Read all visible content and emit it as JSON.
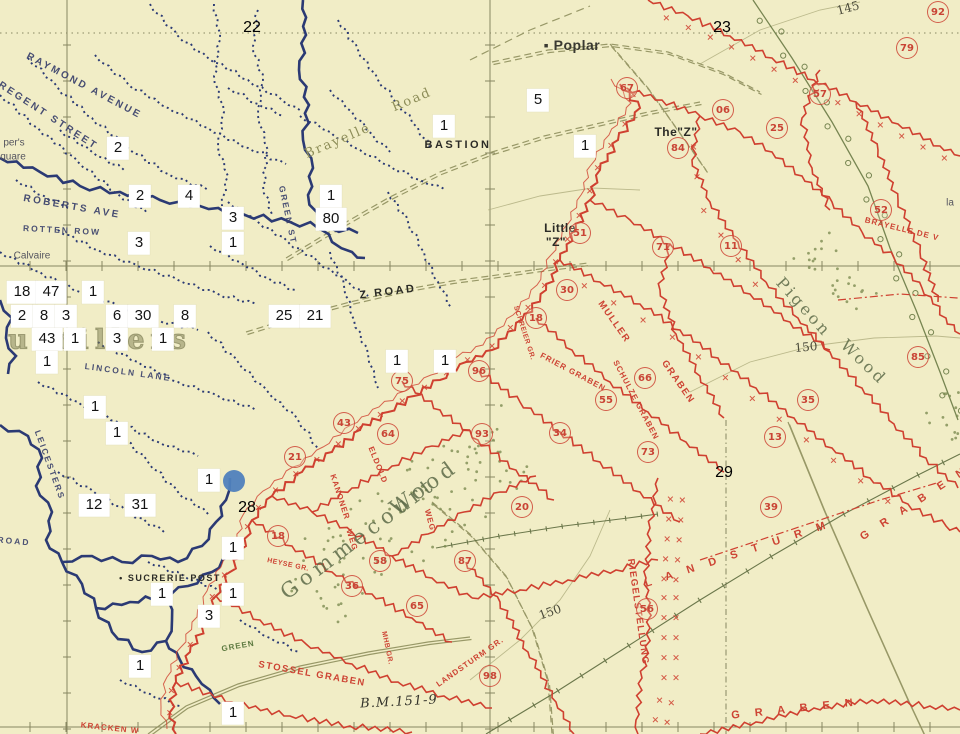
{
  "colors": {
    "background": "#f1edc6",
    "british_trench_blue": "#2b3a74",
    "german_trench_red": "#cf4030",
    "road_olive": "#8f8f5d",
    "wood_green": "#7d8c52",
    "grid_olive": "#6e6e49",
    "annotation_box_bg": "#ffffff",
    "annotation_text": "#141414",
    "marker_blue": "#4f81bd"
  },
  "grid_square_numbers": [
    {
      "text": "22",
      "x": 252,
      "y": 28
    },
    {
      "text": "23",
      "x": 722,
      "y": 28
    },
    {
      "text": "28",
      "x": 247,
      "y": 508
    },
    {
      "text": "29",
      "x": 724,
      "y": 473
    }
  ],
  "map_labels": [
    {
      "text": "RAYMOND AVENUE",
      "x": 84,
      "y": 86,
      "rot": 28,
      "cls": "street"
    },
    {
      "text": "REGENT STREET",
      "x": 48,
      "y": 116,
      "rot": 33,
      "cls": "street"
    },
    {
      "text": "ROBERTS AVE",
      "x": 72,
      "y": 207,
      "rot": 10,
      "cls": "street"
    },
    {
      "text": "ROTTEN ROW",
      "x": 62,
      "y": 230,
      "rot": 3,
      "cls": "street-small"
    },
    {
      "text": "GREEN ST",
      "x": 288,
      "y": 215,
      "rot": 78,
      "cls": "street-small"
    },
    {
      "text": "per's",
      "x": 14,
      "y": 143,
      "rot": 0,
      "cls": "frag"
    },
    {
      "text": "quare",
      "x": 13,
      "y": 157,
      "rot": 0,
      "cls": "frag"
    },
    {
      "text": "Calvaire",
      "x": 32,
      "y": 256,
      "rot": 0,
      "cls": "frag"
    },
    {
      "text": "LINCOLN LANE",
      "x": 128,
      "y": 372,
      "rot": 8,
      "cls": "street-small"
    },
    {
      "text": "LEICESTERS",
      "x": 50,
      "y": 465,
      "rot": 70,
      "cls": "street-small"
    },
    {
      "text": "ROAD",
      "x": 14,
      "y": 541,
      "rot": 5,
      "cls": "street-small"
    },
    {
      "text": "• SUCRERIE POST",
      "x": 170,
      "y": 578,
      "rot": 0,
      "cls": "caps-small"
    },
    {
      "text": "BASTION",
      "x": 458,
      "y": 145,
      "rot": 0,
      "cls": "caps"
    },
    {
      "text": "Z ROAD",
      "x": 388,
      "y": 292,
      "rot": -7,
      "cls": "caps"
    },
    {
      "text": "▪ Poplar",
      "x": 572,
      "y": 45,
      "rot": 0,
      "cls": "poplar"
    },
    {
      "text": "The\"Z\"",
      "x": 676,
      "y": 132,
      "rot": 0,
      "cls": "caps-mid"
    },
    {
      "text": "Little",
      "x": 560,
      "y": 228,
      "rot": 0,
      "cls": "caps-mid"
    },
    {
      "text": "\"Z\"",
      "x": 556,
      "y": 242,
      "rot": 0,
      "cls": "caps-mid"
    },
    {
      "text": "Gommecourt",
      "x": 358,
      "y": 538,
      "rot": -37,
      "cls": "wood-big"
    },
    {
      "text": "Wood",
      "x": 424,
      "y": 487,
      "rot": -36,
      "cls": "wood-big"
    },
    {
      "text": "Pigeon",
      "x": 804,
      "y": 307,
      "rot": 48,
      "cls": "wood-mid"
    },
    {
      "text": "Wood",
      "x": 864,
      "y": 362,
      "rot": 44,
      "cls": "wood-mid"
    },
    {
      "text": "Brayelle",
      "x": 338,
      "y": 141,
      "rot": -23,
      "cls": "road-name"
    },
    {
      "text": "Road",
      "x": 412,
      "y": 100,
      "rot": -23,
      "cls": "road-name"
    },
    {
      "text": "la",
      "x": 950,
      "y": 203,
      "rot": 0,
      "cls": "frag"
    },
    {
      "text": "145",
      "x": 848,
      "y": 8,
      "rot": -15,
      "cls": "contour"
    },
    {
      "text": "150",
      "x": 806,
      "y": 347,
      "rot": -5,
      "cls": "contour"
    },
    {
      "text": "150",
      "x": 550,
      "y": 612,
      "rot": -20,
      "cls": "contour"
    },
    {
      "text": "B.M.151-9",
      "x": 399,
      "y": 702,
      "rot": -3,
      "cls": "bm"
    },
    {
      "text": "GREEN",
      "x": 238,
      "y": 646,
      "rot": -10,
      "cls": "green-frag"
    },
    {
      "text": "uevillers",
      "x": 100,
      "y": 340,
      "rot": 0,
      "cls": "village"
    }
  ],
  "trench_name_labels": [
    {
      "text": "BRAYELLE DE V",
      "x": 902,
      "y": 229,
      "rot": 14,
      "cls": "red-name-sm"
    },
    {
      "text": "MULLER",
      "x": 614,
      "y": 322,
      "rot": 55,
      "cls": "red-name"
    },
    {
      "text": "GRABEN",
      "x": 678,
      "y": 382,
      "rot": 55,
      "cls": "red-name"
    },
    {
      "text": "FRIER GRABEN",
      "x": 573,
      "y": 372,
      "rot": 28,
      "cls": "red-name-sm"
    },
    {
      "text": "SCHULZE GRABEN",
      "x": 636,
      "y": 400,
      "rot": 62,
      "cls": "red-name-sm"
    },
    {
      "text": "SCHREIER GR.",
      "x": 524,
      "y": 333,
      "rot": 72,
      "cls": "red-name-tiny"
    },
    {
      "text": "KANONER",
      "x": 340,
      "y": 497,
      "rot": 72,
      "cls": "red-name-sm"
    },
    {
      "text": "WEG",
      "x": 352,
      "y": 540,
      "rot": 72,
      "cls": "red-name-sm"
    },
    {
      "text": "ELDOLD",
      "x": 378,
      "y": 465,
      "rot": 68,
      "cls": "red-name-sm"
    },
    {
      "text": "WEG",
      "x": 430,
      "y": 520,
      "rot": 75,
      "cls": "red-name-sm"
    },
    {
      "text": "STOSSEL GRABEN",
      "x": 312,
      "y": 674,
      "rot": 10,
      "cls": "red-name"
    },
    {
      "text": "RIEGELSTELLUNG",
      "x": 638,
      "y": 612,
      "rot": 82,
      "cls": "red-name"
    },
    {
      "text": "LANDSTURM GR.",
      "x": 470,
      "y": 662,
      "rot": -35,
      "cls": "red-name-sm"
    },
    {
      "text": "L A N D S T U R M",
      "x": 738,
      "y": 554,
      "rot": -18,
      "cls": "red-spread"
    },
    {
      "text": "G R A B E N",
      "x": 915,
      "y": 503,
      "rot": -33,
      "cls": "red-spread"
    },
    {
      "text": "G R A B E N",
      "x": 795,
      "y": 709,
      "rot": -6,
      "cls": "red-spread"
    },
    {
      "text": "KRACKEN W",
      "x": 110,
      "y": 728,
      "rot": 6,
      "cls": "red-name-sm"
    },
    {
      "text": "MHB GR.",
      "x": 387,
      "y": 648,
      "rot": 78,
      "cls": "red-name-tiny"
    },
    {
      "text": "HEYSE GR.",
      "x": 288,
      "y": 565,
      "rot": 12,
      "cls": "red-name-tiny"
    }
  ],
  "circled_numbers": [
    {
      "n": "92",
      "x": 938,
      "y": 12
    },
    {
      "n": "79",
      "x": 907,
      "y": 48
    },
    {
      "n": "67",
      "x": 627,
      "y": 88
    },
    {
      "n": "57",
      "x": 820,
      "y": 94
    },
    {
      "n": "06",
      "x": 723,
      "y": 110
    },
    {
      "n": "25",
      "x": 777,
      "y": 128
    },
    {
      "n": "84",
      "x": 678,
      "y": 148
    },
    {
      "n": "52",
      "x": 881,
      "y": 210
    },
    {
      "n": "51",
      "x": 580,
      "y": 233
    },
    {
      "n": "71",
      "x": 663,
      "y": 247
    },
    {
      "n": "11",
      "x": 731,
      "y": 246
    },
    {
      "n": "30",
      "x": 567,
      "y": 290
    },
    {
      "n": "18",
      "x": 536,
      "y": 318
    },
    {
      "n": "96",
      "x": 479,
      "y": 371
    },
    {
      "n": "75",
      "x": 402,
      "y": 381
    },
    {
      "n": "66",
      "x": 645,
      "y": 378
    },
    {
      "n": "55",
      "x": 606,
      "y": 400
    },
    {
      "n": "35",
      "x": 808,
      "y": 400
    },
    {
      "n": "85",
      "x": 918,
      "y": 357
    },
    {
      "n": "43",
      "x": 344,
      "y": 423
    },
    {
      "n": "64",
      "x": 388,
      "y": 434
    },
    {
      "n": "93",
      "x": 482,
      "y": 434
    },
    {
      "n": "34",
      "x": 560,
      "y": 433
    },
    {
      "n": "13",
      "x": 775,
      "y": 437
    },
    {
      "n": "73",
      "x": 648,
      "y": 452
    },
    {
      "n": "21",
      "x": 295,
      "y": 457
    },
    {
      "n": "20",
      "x": 522,
      "y": 507
    },
    {
      "n": "39",
      "x": 771,
      "y": 507
    },
    {
      "n": "18",
      "x": 278,
      "y": 536
    },
    {
      "n": "58",
      "x": 380,
      "y": 561
    },
    {
      "n": "87",
      "x": 465,
      "y": 561
    },
    {
      "n": "36",
      "x": 352,
      "y": 586
    },
    {
      "n": "65",
      "x": 417,
      "y": 606
    },
    {
      "n": "56",
      "x": 647,
      "y": 609
    },
    {
      "n": "98",
      "x": 490,
      "y": 676
    }
  ],
  "annotations": {
    "boxes": [
      {
        "label": "2",
        "x": 118,
        "y": 148
      },
      {
        "label": "2",
        "x": 140,
        "y": 196
      },
      {
        "label": "4",
        "x": 189,
        "y": 196
      },
      {
        "label": "3",
        "x": 233,
        "y": 218
      },
      {
        "label": "1",
        "x": 233,
        "y": 243
      },
      {
        "label": "3",
        "x": 139,
        "y": 243
      },
      {
        "label": "1",
        "x": 444,
        "y": 126
      },
      {
        "label": "1",
        "x": 331,
        "y": 196
      },
      {
        "label": "80",
        "x": 331,
        "y": 219
      },
      {
        "label": "5",
        "x": 538,
        "y": 100
      },
      {
        "label": "1",
        "x": 585,
        "y": 146
      },
      {
        "label": "18",
        "x": 22,
        "y": 292
      },
      {
        "label": "47",
        "x": 51,
        "y": 292
      },
      {
        "label": "1",
        "x": 93,
        "y": 292
      },
      {
        "label": "2",
        "x": 22,
        "y": 316
      },
      {
        "label": "8",
        "x": 44,
        "y": 316
      },
      {
        "label": "3",
        "x": 66,
        "y": 316
      },
      {
        "label": "6",
        "x": 117,
        "y": 316
      },
      {
        "label": "30",
        "x": 143,
        "y": 316
      },
      {
        "label": "8",
        "x": 185,
        "y": 316
      },
      {
        "label": "43",
        "x": 47,
        "y": 339
      },
      {
        "label": "1",
        "x": 75,
        "y": 339
      },
      {
        "label": "3",
        "x": 117,
        "y": 339
      },
      {
        "label": "1",
        "x": 163,
        "y": 339
      },
      {
        "label": "1",
        "x": 47,
        "y": 362
      },
      {
        "label": "25",
        "x": 284,
        "y": 316
      },
      {
        "label": "21",
        "x": 315,
        "y": 316
      },
      {
        "label": "1",
        "x": 95,
        "y": 407
      },
      {
        "label": "1",
        "x": 117,
        "y": 433
      },
      {
        "label": "1",
        "x": 397,
        "y": 361
      },
      {
        "label": "1",
        "x": 445,
        "y": 361
      },
      {
        "label": "1",
        "x": 209,
        "y": 480
      },
      {
        "label": "12",
        "x": 94,
        "y": 505
      },
      {
        "label": "31",
        "x": 140,
        "y": 505
      },
      {
        "label": "1",
        "x": 233,
        "y": 548
      },
      {
        "label": "1",
        "x": 162,
        "y": 594
      },
      {
        "label": "1",
        "x": 233,
        "y": 594
      },
      {
        "label": "3",
        "x": 209,
        "y": 616
      },
      {
        "label": "1",
        "x": 140,
        "y": 666
      },
      {
        "label": "1",
        "x": 233,
        "y": 713
      }
    ],
    "marker_dot": {
      "x": 234,
      "y": 481
    }
  }
}
